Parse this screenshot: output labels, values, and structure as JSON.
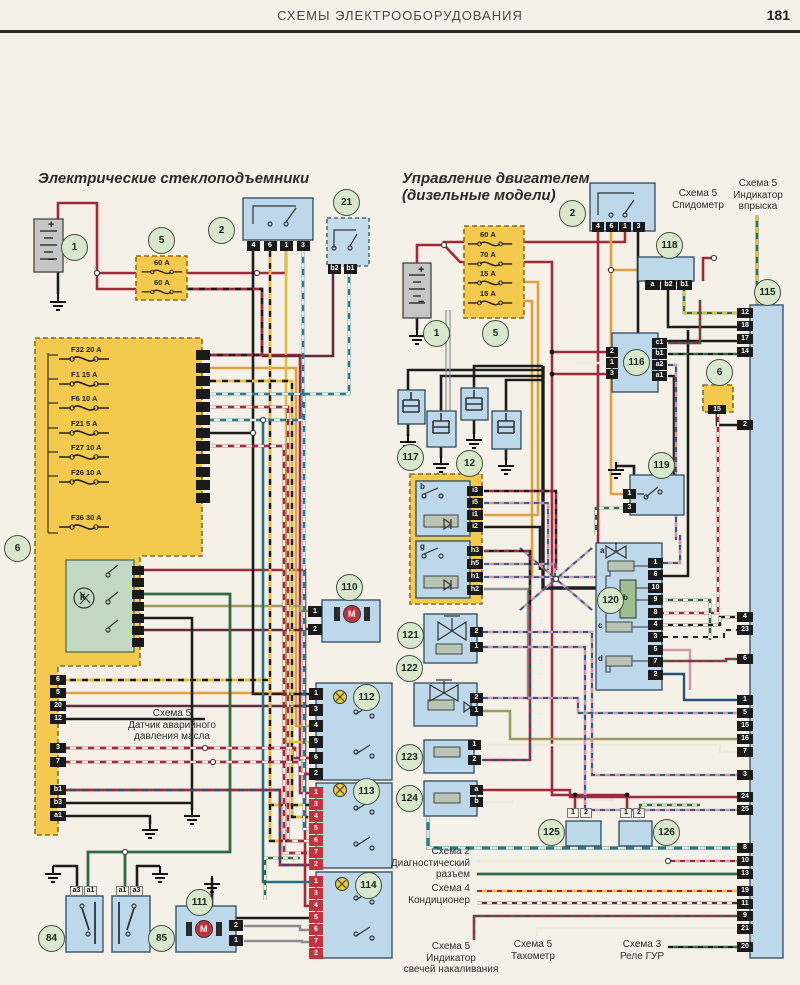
{
  "page": {
    "header": "СХЕМЫ ЭЛЕКТРООБОРУДОВАНИЯ",
    "page_number": "181"
  },
  "colors": {
    "paper": "#f5f1e8",
    "component_blue": "#bdd8ea",
    "fuse_yellow": "#f3ca4e",
    "badge_green": "#d9e7cc",
    "wire_red": "#a1293b",
    "wire_orange": "#dfa13c",
    "wire_teal": "#20708a",
    "wire_green": "#2f6b45",
    "terminal_dark": "#1d1d1d",
    "terminal_red": "#c23340"
  },
  "left": {
    "title": "Электрические стеклоподъемники",
    "battery": {
      "badge": "1",
      "plus": "+",
      "minus": "−"
    },
    "fuse_block": {
      "badge": "5",
      "fuses": [
        "60 А",
        "60 А"
      ]
    },
    "relay": {
      "badge": "2",
      "pins": [
        "4",
        "6",
        "1",
        "3"
      ]
    },
    "comp21": {
      "badge": "21",
      "pins": [
        "b2",
        "b1"
      ]
    },
    "fusebox": {
      "badge": "6",
      "relay_label": "К",
      "fuses": [
        "F32 20 A",
        "F1 15 A",
        "F6 10 A",
        "F21 5 A",
        "F27 10 A",
        "F26 10 A"
      ],
      "fuse36": "F36 30 A",
      "pins_a": [
        "6",
        "5",
        "20",
        "12"
      ],
      "pins_b": [
        "3",
        "7"
      ],
      "pins_c": [
        "b1",
        "b3",
        "a1"
      ]
    },
    "note_oil": "Схема 5\nДатчик аварийного\nдавления масла",
    "comp110": {
      "badge": "110",
      "motor": "М",
      "pins": [
        "1",
        "2"
      ]
    },
    "comp111": {
      "badge": "111",
      "motor": "М",
      "pins": [
        "2",
        "1"
      ]
    },
    "comp112": {
      "badge": "112",
      "pins": [
        "1",
        "3",
        "4",
        "5",
        "6",
        "2"
      ]
    },
    "comp113": {
      "badge": "113",
      "pins": [
        "1",
        "3",
        "4",
        "5",
        "6",
        "7",
        "2"
      ]
    },
    "comp114": {
      "badge": "114",
      "pins": [
        "1",
        "3",
        "4",
        "5",
        "6",
        "7",
        "2"
      ]
    },
    "comp84": {
      "badge": "84",
      "pins": [
        "a3",
        "a1"
      ]
    },
    "comp85": {
      "badge": "85",
      "pins": [
        "a1",
        "a3"
      ]
    }
  },
  "right": {
    "title": "Управление двигателем\n(дизельные модели)",
    "battery": {
      "badge": "1",
      "plus": "+",
      "minus": "−"
    },
    "fuse_block": {
      "badge": "5",
      "fuses": [
        "60 А",
        "70 А",
        "15 А",
        "15 А"
      ]
    },
    "relay": {
      "badge": "2",
      "pins": [
        "4",
        "6",
        "1",
        "3"
      ]
    },
    "comp118": {
      "badge": "118",
      "pins": [
        "a",
        "b2",
        "b1"
      ]
    },
    "comp115": {
      "badge": "115",
      "g1": [
        "12",
        "18",
        "17",
        "14"
      ],
      "g2": [
        "2"
      ],
      "g3": [
        "4",
        "23"
      ],
      "g4": [
        "6"
      ],
      "g5": [
        "1",
        "5",
        "15",
        "16",
        "7"
      ],
      "g6": [
        "3"
      ],
      "g7": [
        "24",
        "25"
      ],
      "g8": [
        "8",
        "10",
        "13"
      ],
      "g9": [
        "19",
        "11"
      ],
      "g10": [
        "9",
        "21"
      ],
      "g11": [
        "20"
      ]
    },
    "comp116": {
      "badge": "116",
      "pins_left": [
        "2",
        "1",
        "3"
      ],
      "pins_right": [
        "c1",
        "b1",
        "a2",
        "a1"
      ]
    },
    "comp6": {
      "badge": "6",
      "pin": "15"
    },
    "comp117": {
      "badge": "117"
    },
    "comp12": {
      "badge": "12"
    },
    "comp119": {
      "badge": "119",
      "pins": [
        "1",
        "3"
      ]
    },
    "comp120": {
      "badge": "120",
      "pins": [
        "1",
        "6",
        "10",
        "9",
        "8",
        "4",
        "3",
        "5",
        "7",
        "2"
      ],
      "label_a": "a",
      "label_b": "b",
      "label_c": "c",
      "label_d": "d"
    },
    "module": {
      "label_b": "b",
      "label_g": "g",
      "pins_b": [
        "i3",
        "i5",
        "i1",
        "i2"
      ],
      "pins_g": [
        "h3",
        "h5",
        "h1",
        "h2"
      ]
    },
    "comp121": {
      "badge": "121",
      "pins": [
        "2",
        "1"
      ]
    },
    "comp122": {
      "badge": "122",
      "pins": [
        "2",
        "1"
      ]
    },
    "comp123": {
      "badge": "123",
      "pins": [
        "1",
        "2"
      ]
    },
    "comp124": {
      "badge": "124",
      "pins": [
        "a",
        "b"
      ]
    },
    "comp125": {
      "badge": "125",
      "pins": [
        "1",
        "2"
      ]
    },
    "comp126": {
      "badge": "126",
      "pins": [
        "1",
        "2"
      ]
    },
    "note_speed": "Схема 5\nСпидометр",
    "note_inj": "Схема 5\nИндикатор\nвпрыска",
    "note_diag": "Схема 2\nДиагностический\nразъем",
    "note_ac": "Схема 4\nКондиционер",
    "note_glow": "Схема 5\nИндикатор\nсвечей накаливания",
    "note_tach": "Схема 5\nТахометр",
    "note_gur": "Схема 3\nРеле ГУР"
  }
}
